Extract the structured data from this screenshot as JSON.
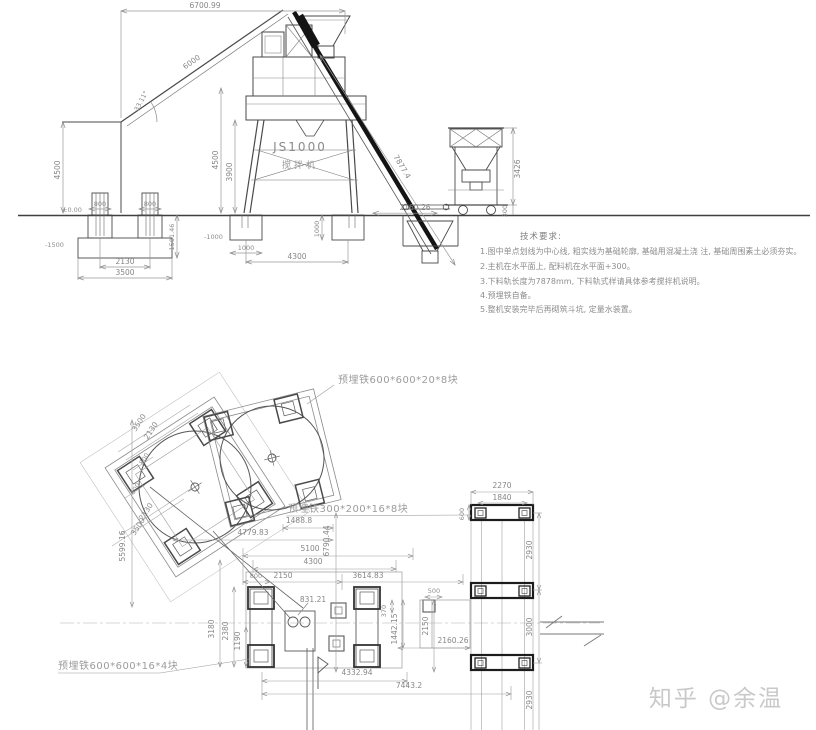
{
  "watermark": {
    "text": "知乎 @余温"
  },
  "elevation": {
    "machine": {
      "model": "JS1000",
      "name": "搅拌机"
    },
    "dims": {
      "top": "6700.99",
      "rail": "6000",
      "angle": "33.11°",
      "h4500_left": "4500",
      "h4500": "4500",
      "h3900": "3900",
      "rail_low": "7877.4",
      "pit_offset": "2160.26",
      "batcher_h": "3426",
      "batcher_base": "300",
      "lvl0": "±0.00",
      "lvl_m1500": "-1500",
      "lvl_m1000": "-1000",
      "w800a": "800",
      "w800b": "800",
      "h1501": "1501.46",
      "s2130": "2130",
      "s3500": "3500",
      "pad_d": "1000",
      "pad_w": "1000",
      "span4300": "4300"
    },
    "notes": {
      "title": "技术要求:",
      "items": [
        "1.图中单点划线为中心线, 粗实线为基础轮廓, 基础用混凝土浇    注, 基础周围素土必须夯实。",
        "2.主机在水平面上, 配料机在水平面+300。",
        "3.下料轨长度为7878mm, 下料轨式样请具体参考搅拌机说明。",
        "4.预埋铁自备。",
        "5.整机安装完毕后再砌筑斗坑, 定量水装置。"
      ]
    }
  },
  "plan": {
    "labels": {
      "top": "预埋铁600*600*20*8块",
      "mid": "预埋铁300*200*16*8块",
      "bottom": "预埋铁600*600*16*4块"
    },
    "dims": {
      "a3500": "3500",
      "a2130": "2130",
      "a800": "800",
      "a600": "600",
      "b2130": "2130",
      "b3500": "3500",
      "v5599": "5599.16",
      "w1488": "1488.8",
      "v6790": "6790.44",
      "w4779": "4779.83",
      "w5100": "5100",
      "w4300": "4300",
      "w800": "800",
      "w2150": "2150",
      "w3614": "3614.83",
      "w500": "500",
      "c831": "831.21",
      "v370": "370",
      "v1442": "1442.15",
      "v2150": "2150",
      "w2160": "2160.26",
      "w4332": "4332.94",
      "w7443": "7443.2",
      "v3180": "3180",
      "v2380": "2380",
      "v1190": "1190",
      "r2270": "2270",
      "r1840": "1840",
      "r600": "600",
      "r2930a": "2930",
      "r3000": "3000",
      "r2930b": "2930"
    }
  }
}
